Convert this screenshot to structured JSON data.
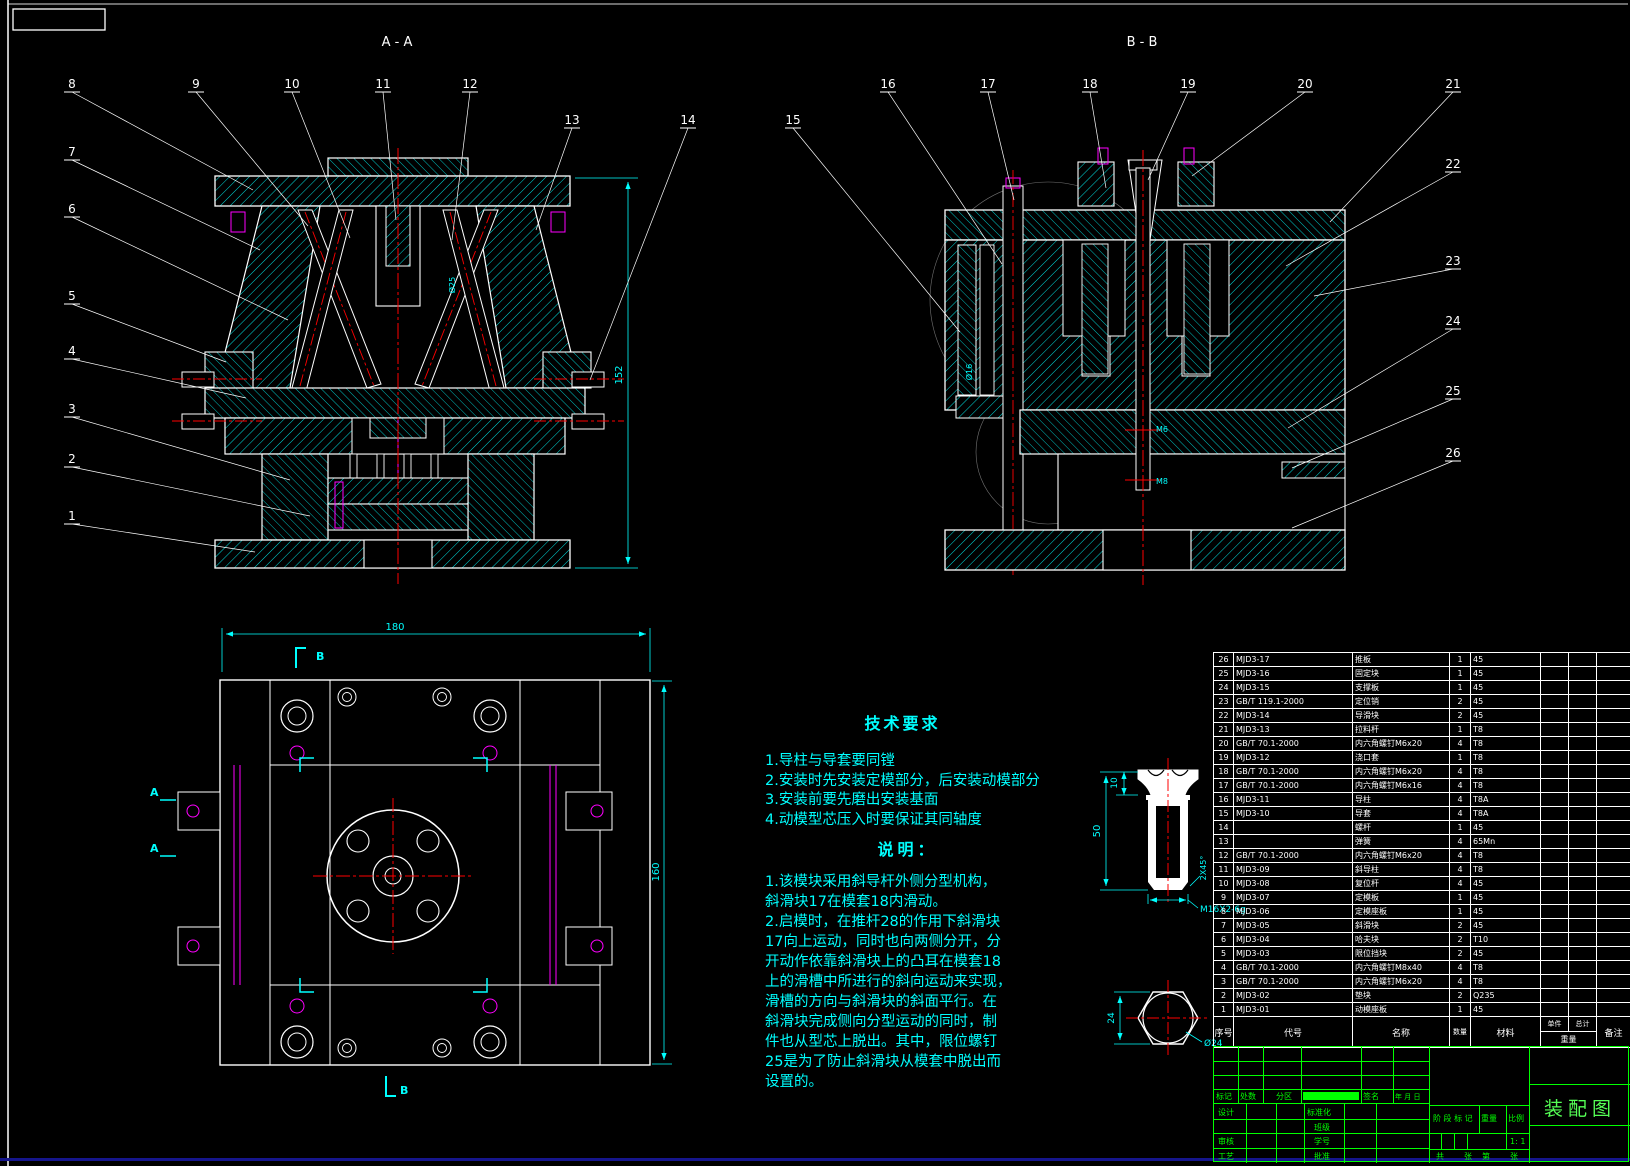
{
  "views": {
    "aa": {
      "label": "A - A"
    },
    "bb": {
      "label": "B - B"
    }
  },
  "callouts": {
    "aa_top": [
      "8",
      "9",
      "10",
      "11",
      "12",
      "13",
      "14"
    ],
    "aa_left": [
      "7",
      "6",
      "5",
      "4",
      "3",
      "2",
      "1"
    ],
    "bb_top": [
      "15",
      "16",
      "17",
      "18",
      "19",
      "20",
      "21"
    ],
    "bb_right": [
      "22",
      "23",
      "24",
      "25",
      "26"
    ]
  },
  "section_marks": {
    "a": "A",
    "b": "B"
  },
  "dimensions": {
    "aa_height": "152",
    "plan_width": "180",
    "plan_height": "160",
    "aa_bore": "Ø25",
    "bb_bore": "Ø16",
    "bb_m6": "M6",
    "bb_m8": "M8",
    "bolt_head_height": "10",
    "bolt_length": "50",
    "bolt_chamfer": "2X45°",
    "bolt_thread": "M16X2-6g",
    "hex_width": "24",
    "hex_dia": "Ø24"
  },
  "tech_requirements": {
    "title": "技术要求",
    "items": [
      "1.导柱与导套要同镗",
      "2.安装时先安装定模部分，后安装动模部分",
      "3.安装前要先磨出安装基面",
      "4.动模型芯压入时要保证其同轴度"
    ]
  },
  "notes": {
    "title": "说明：",
    "lines": [
      "1.该模块采用斜导杆外侧分型机构，",
      "斜滑块17在模套18内滑动。",
      "2.启模时，在推杆28的作用下斜滑块",
      "17向上运动，同时也向两侧分开，分",
      "开动作依靠斜滑块上的凸耳在模套18",
      "上的滑槽中所进行的斜向运动来实现，",
      "滑槽的方向与斜滑块的斜面平行。在",
      "斜滑块完成侧向分型运动的同时，制",
      "件也从型芯上脱出。其中，限位螺钉",
      "25是为了防止斜滑块从模套中脱出而",
      "设置的。"
    ]
  },
  "parts_table": {
    "headers": {
      "no": "序号",
      "code": "代号",
      "name": "名称",
      "qty": "数量",
      "material": "材料",
      "unit": "单件",
      "total": "总计",
      "weight": "重量",
      "remark": "备注"
    },
    "rows": [
      {
        "no": "26",
        "code": "MJD3-17",
        "name": "推板",
        "qty": "1",
        "mat": "45"
      },
      {
        "no": "25",
        "code": "MJD3-16",
        "name": "固定块",
        "qty": "1",
        "mat": "45"
      },
      {
        "no": "24",
        "code": "MJD3-15",
        "name": "支撑板",
        "qty": "1",
        "mat": "45"
      },
      {
        "no": "23",
        "code": "GB/T 119.1-2000",
        "name": "定位销",
        "qty": "2",
        "mat": "45"
      },
      {
        "no": "22",
        "code": "MJD3-14",
        "name": "导滑块",
        "qty": "2",
        "mat": "45"
      },
      {
        "no": "21",
        "code": "MJD3-13",
        "name": "拉料杆",
        "qty": "1",
        "mat": "T8"
      },
      {
        "no": "20",
        "code": "GB/T 70.1-2000",
        "name": "内六角螺钉M6x20",
        "qty": "4",
        "mat": "T8"
      },
      {
        "no": "19",
        "code": "MJD3-12",
        "name": "浇口套",
        "qty": "1",
        "mat": "T8"
      },
      {
        "no": "18",
        "code": "GB/T 70.1-2000",
        "name": "内六角螺钉M6x20",
        "qty": "4",
        "mat": "T8"
      },
      {
        "no": "17",
        "code": "GB/T 70.1-2000",
        "name": "内六角螺钉M6x16",
        "qty": "4",
        "mat": "T8"
      },
      {
        "no": "16",
        "code": "MJD3-11",
        "name": "导柱",
        "qty": "4",
        "mat": "T8A"
      },
      {
        "no": "15",
        "code": "MJD3-10",
        "name": "导套",
        "qty": "4",
        "mat": "T8A"
      },
      {
        "no": "14",
        "code": "",
        "name": "螺杆",
        "qty": "1",
        "mat": "45"
      },
      {
        "no": "13",
        "code": "",
        "name": "弹簧",
        "qty": "4",
        "mat": "65Mn"
      },
      {
        "no": "12",
        "code": "GB/T 70.1-2000",
        "name": "内六角螺钉M6x20",
        "qty": "4",
        "mat": "T8"
      },
      {
        "no": "11",
        "code": "MJD3-09",
        "name": "斜导柱",
        "qty": "4",
        "mat": "T8"
      },
      {
        "no": "10",
        "code": "MJD3-08",
        "name": "复位杆",
        "qty": "4",
        "mat": "45"
      },
      {
        "no": "9",
        "code": "MJD3-07",
        "name": "定模板",
        "qty": "1",
        "mat": "45"
      },
      {
        "no": "8",
        "code": "MJD3-06",
        "name": "定模座板",
        "qty": "1",
        "mat": "45"
      },
      {
        "no": "7",
        "code": "MJD3-05",
        "name": "斜滑块",
        "qty": "2",
        "mat": "45"
      },
      {
        "no": "6",
        "code": "MJD3-04",
        "name": "哈夫块",
        "qty": "2",
        "mat": "T10"
      },
      {
        "no": "5",
        "code": "MJD3-03",
        "name": "限位挡块",
        "qty": "2",
        "mat": "45"
      },
      {
        "no": "4",
        "code": "GB/T 70.1-2000",
        "name": "内六角螺钉M8x40",
        "qty": "4",
        "mat": "T8"
      },
      {
        "no": "3",
        "code": "GB/T 70.1-2000",
        "name": "内六角螺钉M6x20",
        "qty": "4",
        "mat": "T8"
      },
      {
        "no": "2",
        "code": "MJD3-02",
        "name": "垫块",
        "qty": "2",
        "mat": "Q235"
      },
      {
        "no": "1",
        "code": "MJD3-01",
        "name": "动模座板",
        "qty": "1",
        "mat": "45"
      }
    ]
  },
  "title_block": {
    "mark": "标记",
    "count": "处数",
    "zone": "分区",
    "sign": "签名",
    "date": "年 月 日",
    "design": "设计",
    "standard": "标准化",
    "class": "班级",
    "student": "学号",
    "check": "审核",
    "process": "工艺",
    "approve": "批准",
    "stage": "阶 段 标 记",
    "weight": "重量",
    "scale": "比例",
    "scale_value": "1: 1",
    "sheets_total": "共",
    "sheets_z1": "张",
    "sheets_no": "第",
    "sheets_z2": "张",
    "title": "装配图"
  },
  "colors": {
    "hatch": "#00e0e0",
    "accent": "#00ffff",
    "grid": "#ffffff",
    "titleblock": "#00ff00",
    "centerline": "#ff0000",
    "hidden": "#ff00ff"
  }
}
